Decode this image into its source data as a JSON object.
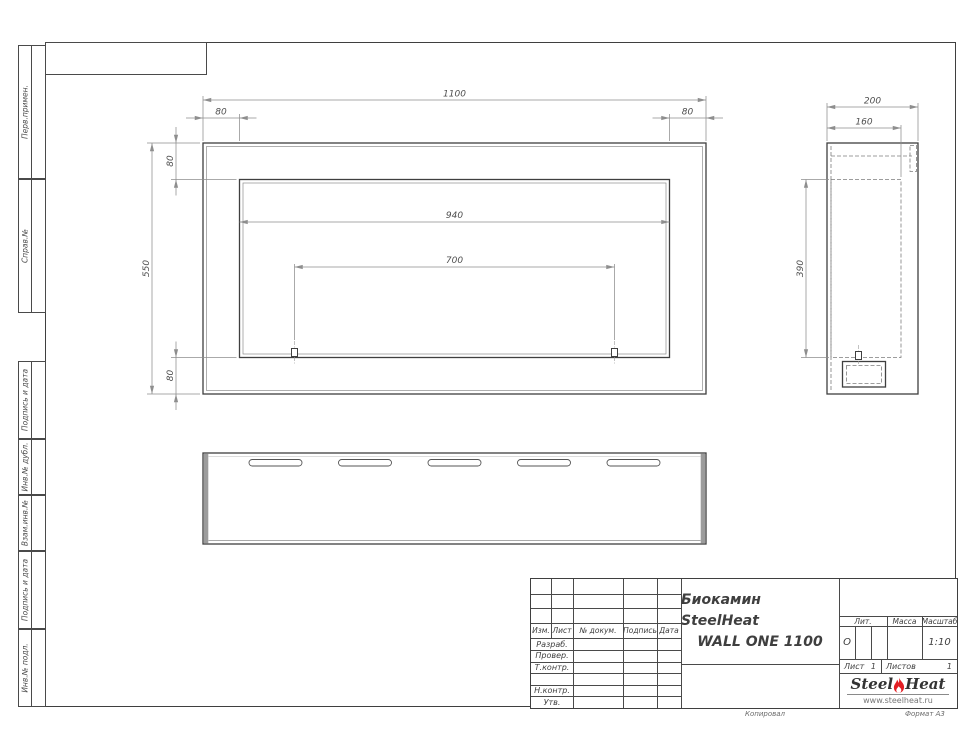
{
  "views": {
    "front": {
      "dims": {
        "width": "1100",
        "left_margin": "80",
        "right_margin": "80",
        "top_margin": "80",
        "height": "550",
        "bottom_margin": "80",
        "opening_width": "940",
        "bracket_spacing": "700"
      }
    },
    "side": {
      "dims": {
        "depth": "200",
        "inner_depth": "160",
        "opening_height": "390"
      }
    }
  },
  "left_stamps": [
    "Перв.примен.",
    "Справ.№",
    "Подпись и дата",
    "Инв.№ дубл.",
    "Взам.инв.№",
    "Подпись и дата",
    "Инв.№ подл."
  ],
  "title_block": {
    "header": [
      "Изм.",
      "Лист",
      "№ докум.",
      "Подпись",
      "Дата"
    ],
    "sign_rows": [
      "Разраб.",
      "Провер.",
      "Т.контр.",
      "",
      "Н.контр.",
      "Утв."
    ],
    "doc_title_line1": "Биокамин SteelHeat",
    "doc_title_line2": "WALL ONE 1100",
    "lit_label": "Лит.",
    "lit_value": "О",
    "mass_label": "Масса",
    "scale_label": "Масштаб",
    "scale_value": "1:10",
    "sheet_label": "Лист",
    "sheet_value": "1",
    "sheets_label": "Листов",
    "sheets_value": "1",
    "logo": {
      "word1": "Steel",
      "word2": "Heat",
      "url": "www.steelheat.ru"
    },
    "footer_copy": "Копировал",
    "footer_format": "Формат А3"
  },
  "colors": {
    "contour": "#3f3f3f",
    "thin_line": "#8e8e8e",
    "dim_text": "#4f4f4f",
    "flame_red": "#e31e24"
  }
}
